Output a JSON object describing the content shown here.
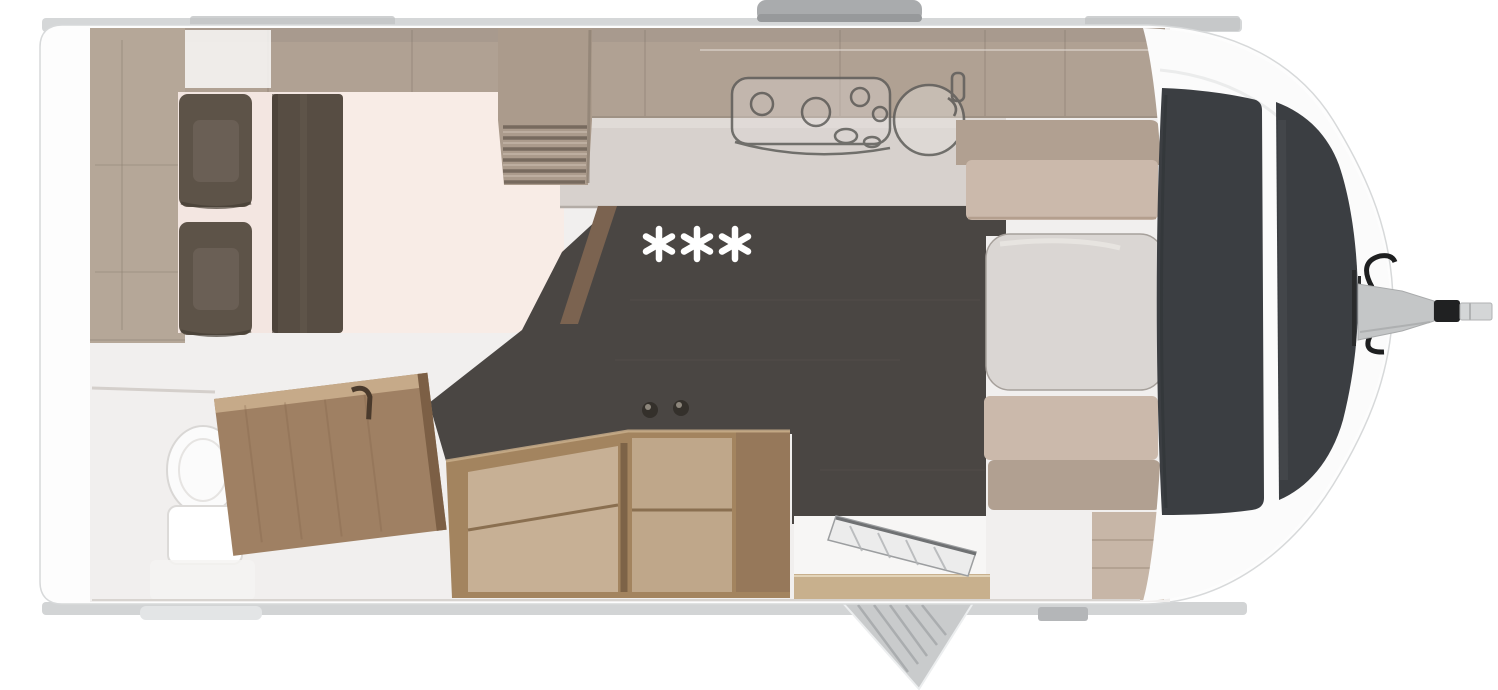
{
  "floorplan": {
    "marker_text": "***",
    "colors": {
      "body": "#fdfdfd",
      "shadow": "#d2d4d5",
      "overhead_band": "#b0a193",
      "wood_light": "#b5a798",
      "mattress": "#f3e6e1",
      "mattress_light": "#f8ece6",
      "pillow": "#5d5348",
      "runner": "#574d43",
      "counter": "#d7d1cd",
      "appliance_outline": "#5f5e5b",
      "floor_dark": "#4a4643",
      "wood_furniture": "#a3845f",
      "wood_shelf_inner": "#cbb59b",
      "door_wood": "#9f8063",
      "bench": "#cbb9ab",
      "bench_back": "#b1a091",
      "table": "#dad6d3",
      "window": "#3b3e42",
      "metal": "#c9cbcc",
      "hitch_metal": "#c4c6c7",
      "hitch_dark": "#202122",
      "sill": "#c8b08d",
      "marker": "#ffffff"
    }
  }
}
